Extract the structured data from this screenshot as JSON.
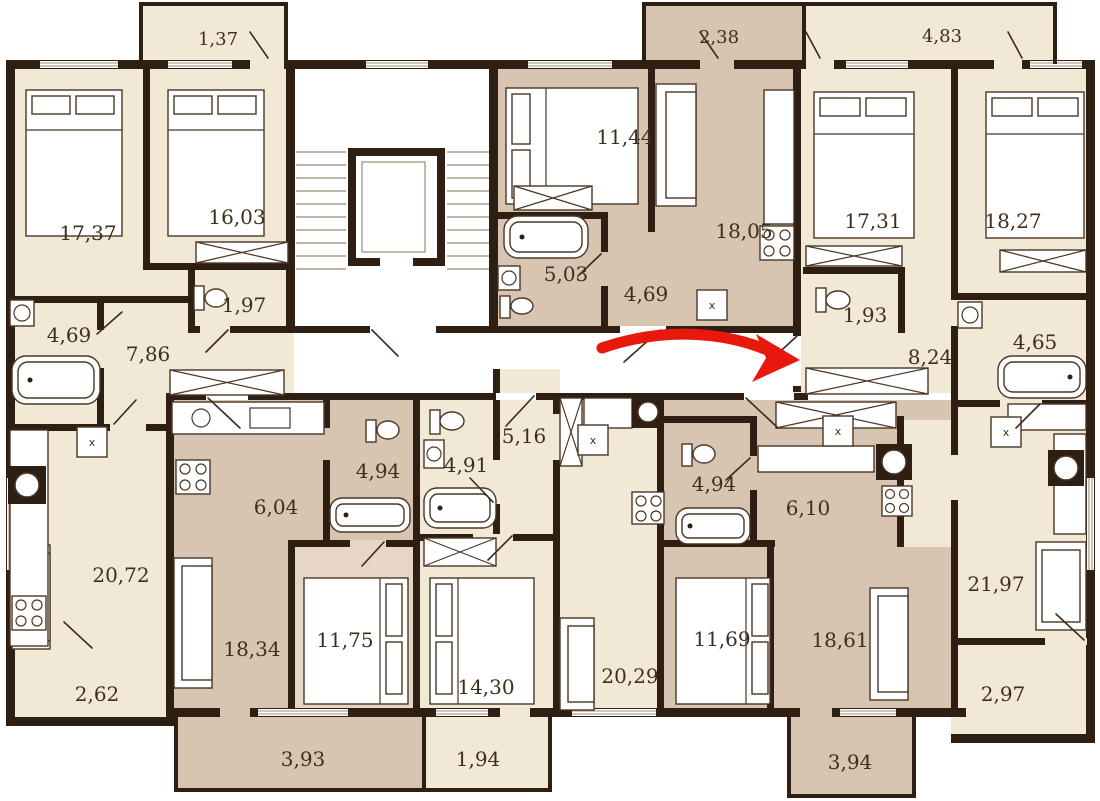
{
  "document": {
    "type": "apartment-floor-plan",
    "description": "Residential building typical floor plan with room areas in square meters (comma decimals), a central stairwell with elevator, and a red arrow marking an apartment entrance"
  },
  "colors": {
    "wall": "#2e1f12",
    "room_light": "#f1e9d6",
    "room_dark": "#d8c5b1",
    "room_mid": "#e7d6c5",
    "background": "#ffffff",
    "arrow": "#e8190c"
  },
  "arrow": {
    "meaning": "entrance-indicator",
    "color": "#e8190c"
  },
  "washer_label": "x",
  "rooms": [
    {
      "name": "balcony-1-37",
      "area": "1,37"
    },
    {
      "name": "bedroom-17-37",
      "area": "17,37"
    },
    {
      "name": "bedroom-16-03",
      "area": "16,03"
    },
    {
      "name": "wc-1-97",
      "area": "1,97"
    },
    {
      "name": "bath-4-69",
      "area": "4,69"
    },
    {
      "name": "hall-7-86",
      "area": "7,86"
    },
    {
      "name": "bedroom-11-44",
      "area": "11,44"
    },
    {
      "name": "living-18-05",
      "area": "18,05"
    },
    {
      "name": "bath-5-03",
      "area": "5,03"
    },
    {
      "name": "hall-4-69",
      "area": "4,69"
    },
    {
      "name": "balcony-2-38",
      "area": "2,38"
    },
    {
      "name": "balcony-4-83",
      "area": "4,83"
    },
    {
      "name": "bedroom-17-31",
      "area": "17,31"
    },
    {
      "name": "bedroom-18-27",
      "area": "18,27"
    },
    {
      "name": "wc-1-93",
      "area": "1,93"
    },
    {
      "name": "hall-8-24",
      "area": "8,24"
    },
    {
      "name": "bath-4-65",
      "area": "4,65"
    },
    {
      "name": "living-kitchen-20-72",
      "area": "20,72"
    },
    {
      "name": "balcony-2-62",
      "area": "2,62"
    },
    {
      "name": "kitchen-6-04",
      "area": "6,04"
    },
    {
      "name": "bath-4-94-a",
      "area": "4,94"
    },
    {
      "name": "bath-4-91",
      "area": "4,91"
    },
    {
      "name": "hall-5-16",
      "area": "5,16"
    },
    {
      "name": "bath-4-94-b",
      "area": "4,94"
    },
    {
      "name": "kitchen-6-10",
      "area": "6,10"
    },
    {
      "name": "living-18-34",
      "area": "18,34"
    },
    {
      "name": "bedroom-11-75",
      "area": "11,75"
    },
    {
      "name": "bedroom-14-30",
      "area": "14,30"
    },
    {
      "name": "living-kitchen-20-29",
      "area": "20,29"
    },
    {
      "name": "bedroom-11-69",
      "area": "11,69"
    },
    {
      "name": "living-18-61",
      "area": "18,61"
    },
    {
      "name": "living-kitchen-21-97",
      "area": "21,97"
    },
    {
      "name": "balcony-2-97",
      "area": "2,97"
    },
    {
      "name": "balcony-3-93",
      "area": "3,93"
    },
    {
      "name": "balcony-1-94",
      "area": "1,94"
    },
    {
      "name": "balcony-3-94",
      "area": "3,94"
    }
  ]
}
